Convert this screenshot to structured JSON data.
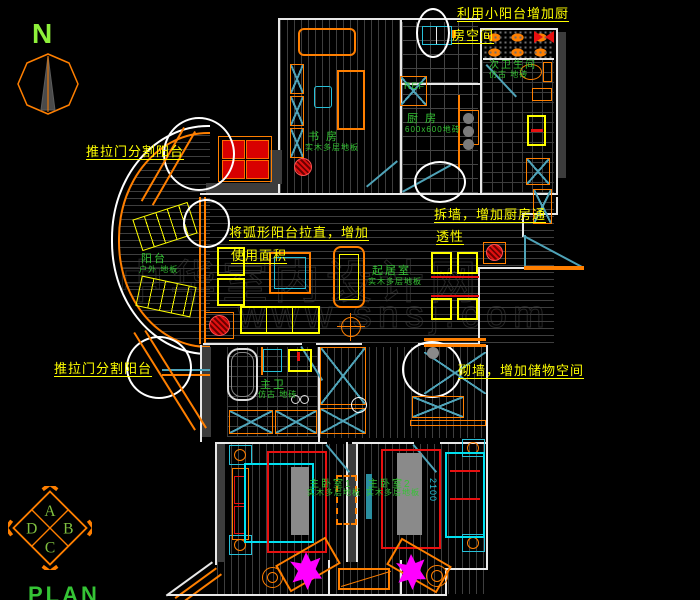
{
  "drawing": {
    "compass_label": "N",
    "plan_label": "PLAN",
    "index_quadrants": [
      "A",
      "B",
      "C",
      "D"
    ],
    "watermark_line1": "中华室内设计网",
    "watermark_line2": "www.snsj.com"
  },
  "annotations": {
    "kitchen_balcony_1": "利用小阳台增加厨",
    "kitchen_balcony_2": "房空间",
    "sliding_door_top": "推拉门分割阳台",
    "straighten_1": "将弧形阳台拉直，增加",
    "straighten_2": "使用面积",
    "demolish_1": "拆墙，增加厨房通",
    "demolish_2": "透性",
    "sliding_door_bottom": "推拉门分割阳台",
    "build_wall": "砌墙，增加储物空间"
  },
  "rooms": {
    "study": "书 房",
    "study_floor": "实木多层地板",
    "kitchen": "厨 房",
    "kitchen_floor": "600x600地砖",
    "second_bath": "次卫生间",
    "second_bath_floor": "仿古 地砖",
    "balcony": "阳台",
    "balcony_floor": "户外 地板",
    "living": "起居室",
    "living_floor": "实木多层地板",
    "master_bath": "主卫",
    "master_bath_floor": "仿古 地砖",
    "bedroom1": "主卧室1",
    "bedroom1_floor": "实木多层地板",
    "bedroom2": "主卧室2",
    "bedroom2_floor": "实木多层地板",
    "fridge_label": "REF"
  },
  "dimensions": {
    "bed_width": "2100"
  },
  "colors": {
    "wall_white": "#e8e8e8",
    "furniture_orange": "#ff7f00",
    "annotation_yellow": "#ffff00",
    "label_green": "#35c435",
    "fixture_cyan": "#27c0d8",
    "accent_red": "#e81010",
    "plant_magenta": "#ff00ff"
  }
}
